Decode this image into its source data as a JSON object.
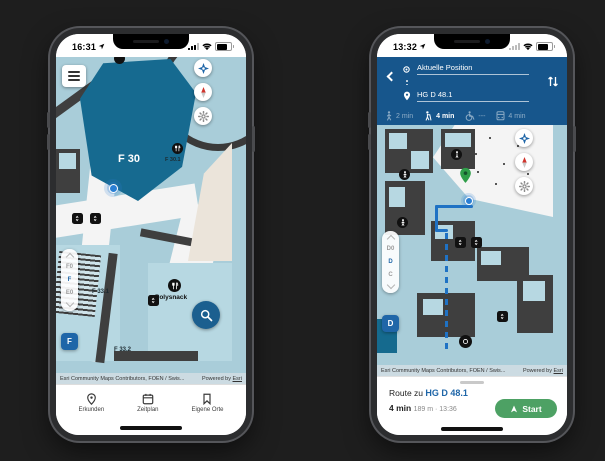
{
  "attribution": {
    "contributors": "Esri Community Maps Contributors, FOEN / Swis...",
    "powered_prefix": "Powered by ",
    "powered_link": "Esri"
  },
  "colors": {
    "accent_blue": "#1f66a8",
    "route_blue": "#1f72c4",
    "panel_blue": "#17568c",
    "room_teal": "#166a90",
    "start_green": "#4da164",
    "destination_green": "#2f9e49",
    "map_base": "#a9cdd9"
  },
  "icons": {
    "menu-icon": "three bars",
    "locate-compass-icon": "blue four-point star",
    "north-needle-icon": "red compass needle",
    "settings-gear-icon": "gear",
    "search-icon": "magnifier",
    "restaurant-icon": "fork and knife",
    "elevator-icon": "up-down arrows",
    "person-icon": "person",
    "swap-icon": "up-down swap arrows",
    "origin-icon": "crosshair",
    "destination-icon": "map pin",
    "pedestrian-icon": "walking person",
    "reduced-mobility-icon": "person with cane",
    "wheelchair-icon": "wheelchair",
    "public-transit-icon": "elevator cabin",
    "pin-icon": "map pin",
    "calendar-icon": "calendar",
    "bookmark-icon": "bookmark",
    "navigate-icon": "navigation arrow"
  },
  "left_phone": {
    "status_time": "16:31",
    "map_labels": {
      "room_main": "F 30",
      "room_sub": "F 30.1",
      "cafe": "Polysnack",
      "room_a": "F 33.1",
      "room_b": "F 33.2"
    },
    "floor_picker": {
      "above": "F0",
      "current": "F",
      "below": "E0",
      "badge": "F"
    },
    "tabs": [
      {
        "label": "Erkunden"
      },
      {
        "label": "Zeitplan"
      },
      {
        "label": "Eigene Orte"
      }
    ]
  },
  "right_phone": {
    "status_time": "13:32",
    "route_form": {
      "origin": "Aktuelle Position",
      "destination": "HG D 48.1"
    },
    "modes": [
      {
        "name": "pedestrian",
        "time": "2 min"
      },
      {
        "name": "reduced-mobility",
        "time": "4 min"
      },
      {
        "name": "wheelchair",
        "time": "---"
      },
      {
        "name": "public-transit",
        "time": "4 min"
      }
    ],
    "floor_picker": {
      "above": "D0",
      "current": "D",
      "below": "C",
      "badge": "D"
    },
    "route_panel": {
      "prefix": "Route zu ",
      "destination": "HG D 48.1",
      "duration": "4 min",
      "distance": "189 m",
      "separator": " · ",
      "arrival": "13:36",
      "start": "Start"
    }
  }
}
